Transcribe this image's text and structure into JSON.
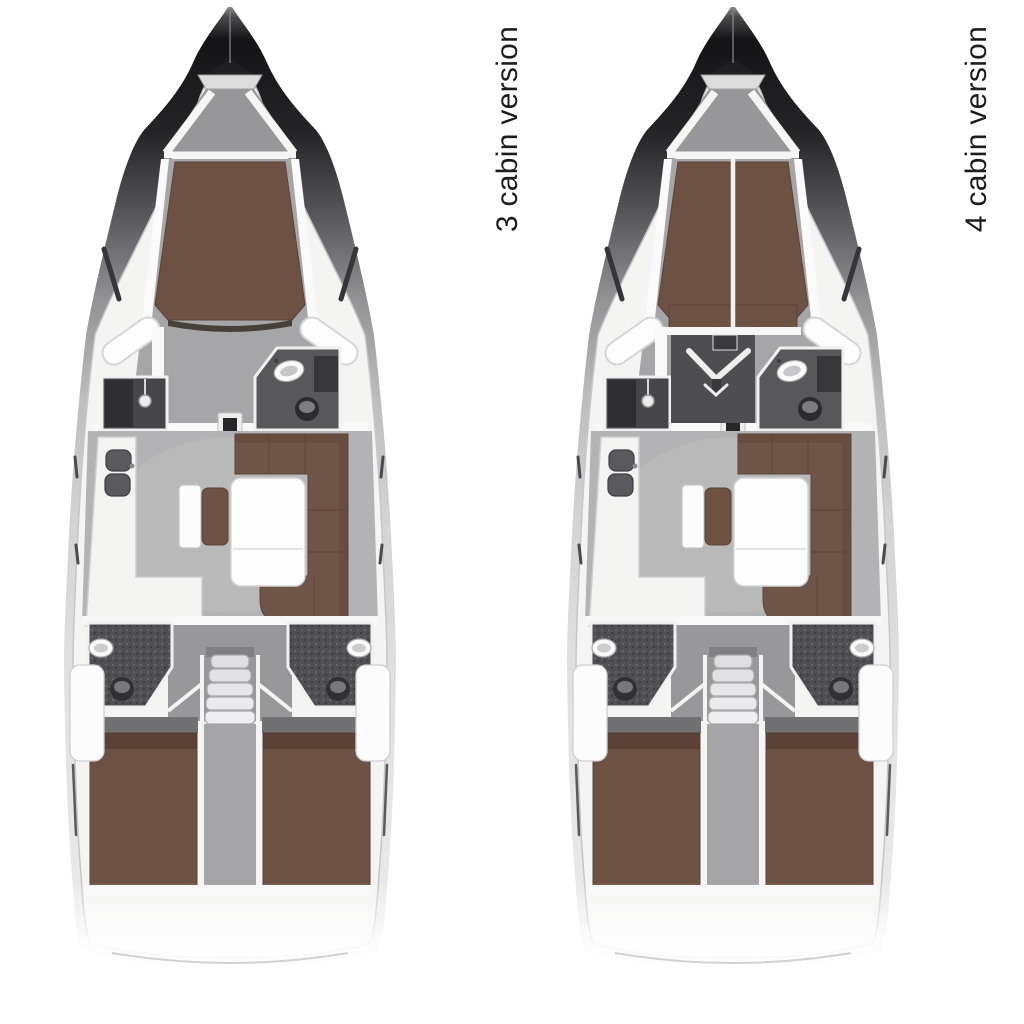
{
  "page": {
    "background": "#ffffff"
  },
  "figures": [
    {
      "id": "plan-3-cabin",
      "label": "3 cabin version",
      "cabins": 3
    },
    {
      "id": "plan-4-cabin",
      "label": "4 cabin version",
      "cabins": 4
    }
  ],
  "palette": {
    "background": "#ffffff",
    "berth_brown": "#6d5143",
    "sofa_brown": "#6f5547",
    "floor_gray": "#b3b3b5",
    "deck_white": "#f4f4f3",
    "hull_dark": "#141416",
    "wet_room_dark": "#4a4a4d",
    "label_text": "#1c1c1c"
  }
}
